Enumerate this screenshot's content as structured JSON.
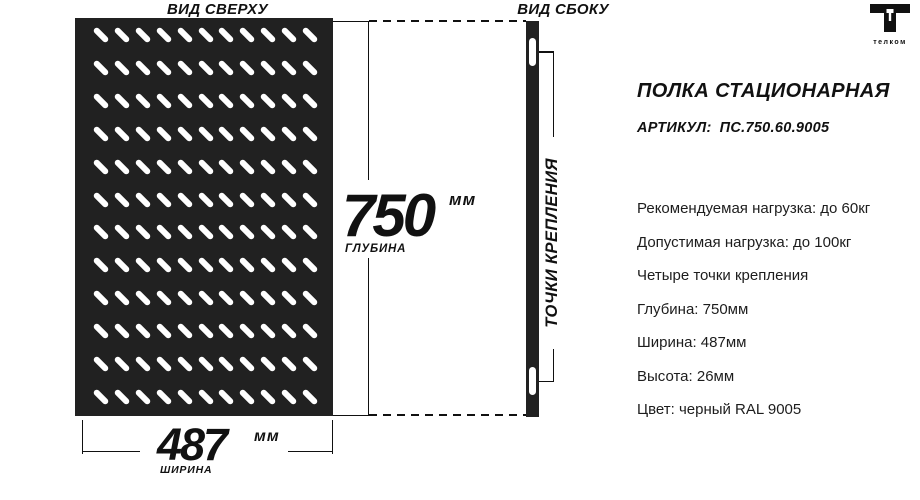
{
  "brand": {
    "name": "телком"
  },
  "top_view": {
    "label": "ВИД СВЕРХУ",
    "holes": {
      "rows": 12,
      "cols": 11
    }
  },
  "side_view": {
    "label": "ВИД СБОКУ",
    "mounting_label": "ТОЧКИ КРЕПЛЕНИЯ"
  },
  "dimensions": {
    "depth": {
      "value": "750",
      "unit": "мм",
      "caption": "ГЛУБИНА"
    },
    "width": {
      "value": "487",
      "unit": "мм",
      "caption": "ШИРИНА"
    }
  },
  "product": {
    "title": "ПОЛКА СТАЦИОНАРНАЯ",
    "article_label": "АРТИКУЛ:",
    "article_value": "ПС.750.60.9005",
    "specs": [
      "Рекомендуемая нагрузка: до 60кг",
      "Допустимая нагрузка: до 100кг",
      "Четыре точки крепления",
      "Глубина: 750мм",
      "Ширина: 487мм",
      "Высота: 26мм",
      "Цвет: черный RAL 9005"
    ]
  },
  "colors": {
    "panel": "#212121",
    "ink": "#111111",
    "background": "#ffffff",
    "hole": "#ffffff"
  }
}
